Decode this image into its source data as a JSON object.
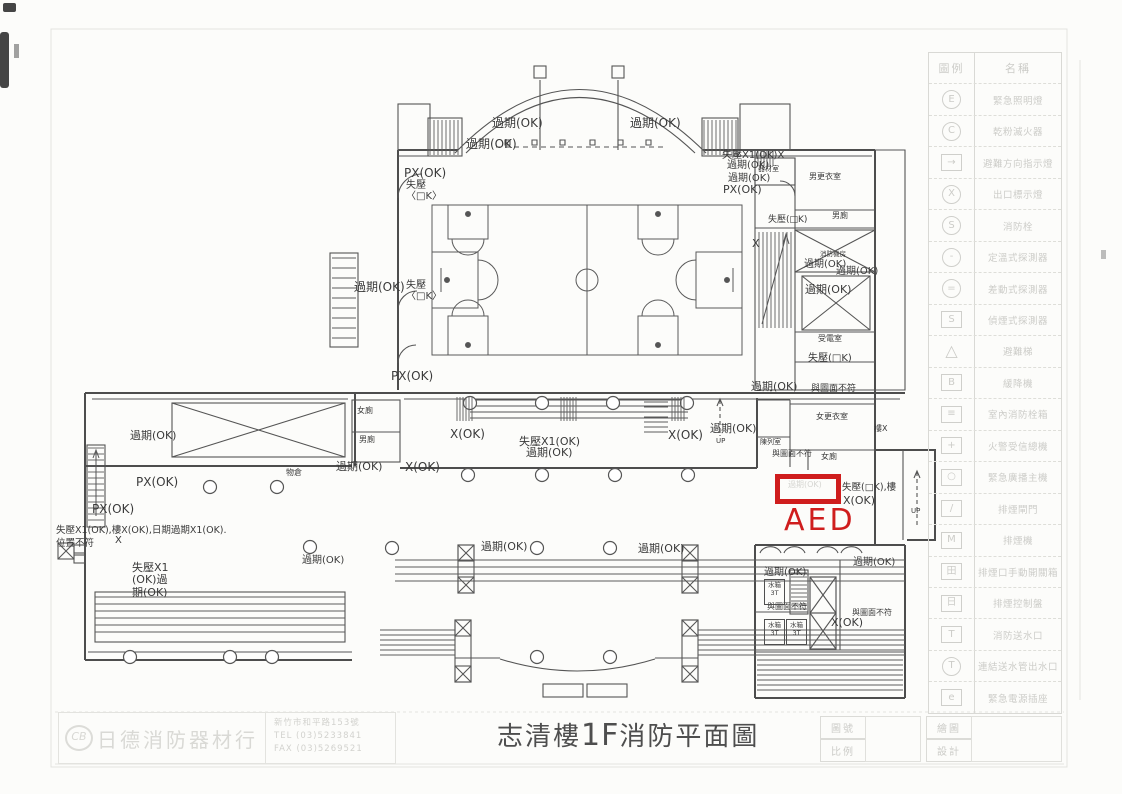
{
  "page": {
    "title_pre": "志清樓",
    "title_floor": "1F",
    "title_post": "消防平面圖"
  },
  "aed": {
    "label": "AED",
    "color": "#cf1d1d"
  },
  "colors": {
    "ink": "#4e4e4e",
    "faint": "#ccccc8",
    "aed_red": "#cf1d1d"
  },
  "annotations": [
    {
      "x": 492,
      "y": 117,
      "t": "過期(OK)",
      "fs": 12
    },
    {
      "x": 630,
      "y": 117,
      "t": "過期(OK)",
      "fs": 12
    },
    {
      "x": 466,
      "y": 138,
      "t": "過期(OK)",
      "fs": 12
    },
    {
      "x": 722,
      "y": 150,
      "t": "失壓X1(OK)X",
      "fs": 10
    },
    {
      "x": 727,
      "y": 160,
      "t": "過期(OK)",
      "fs": 10
    },
    {
      "x": 728,
      "y": 173,
      "t": "過期(OK)",
      "fs": 10
    },
    {
      "x": 723,
      "y": 184,
      "t": "PX(OK)",
      "fs": 11
    },
    {
      "x": 404,
      "y": 167,
      "t": "PX(OK)",
      "fs": 12
    },
    {
      "x": 406,
      "y": 180,
      "t": "失壓",
      "fs": 10
    },
    {
      "x": 406,
      "y": 191,
      "t": "〈□K〉",
      "fs": 10
    },
    {
      "x": 354,
      "y": 281,
      "t": "過期(OK)",
      "fs": 12
    },
    {
      "x": 406,
      "y": 280,
      "t": "失壓",
      "fs": 10
    },
    {
      "x": 406,
      "y": 291,
      "t": "〈□K〉",
      "fs": 10
    },
    {
      "x": 391,
      "y": 370,
      "t": "PX(OK)",
      "fs": 12
    },
    {
      "x": 758,
      "y": 166,
      "t": "器材室",
      "fs": 7
    },
    {
      "x": 809,
      "y": 173,
      "t": "男更衣室",
      "fs": 8
    },
    {
      "x": 832,
      "y": 212,
      "t": "男廁",
      "fs": 8
    },
    {
      "x": 768,
      "y": 215,
      "t": "失壓(□K)",
      "fs": 9
    },
    {
      "x": 752,
      "y": 238,
      "t": "X",
      "fs": 11
    },
    {
      "x": 820,
      "y": 251,
      "t": "消防機房",
      "fs": 6.5
    },
    {
      "x": 804,
      "y": 259,
      "t": "過期(OK)",
      "fs": 10
    },
    {
      "x": 836,
      "y": 266,
      "t": "過期(OK)",
      "fs": 10
    },
    {
      "x": 805,
      "y": 284,
      "t": "過期(OK)",
      "fs": 11
    },
    {
      "x": 818,
      "y": 335,
      "t": "受電室",
      "fs": 8
    },
    {
      "x": 808,
      "y": 353,
      "t": "失壓(□K)",
      "fs": 10
    },
    {
      "x": 751,
      "y": 381,
      "t": "過期(OK)",
      "fs": 11
    },
    {
      "x": 811,
      "y": 384,
      "t": "與圖面不符",
      "fs": 9
    },
    {
      "x": 874,
      "y": 425,
      "t": "樓X",
      "fs": 8
    },
    {
      "x": 816,
      "y": 413,
      "t": "女更衣室",
      "fs": 8
    },
    {
      "x": 760,
      "y": 439,
      "t": "陳列室",
      "fs": 7
    },
    {
      "x": 772,
      "y": 450,
      "t": "與圖面不符",
      "fs": 8
    },
    {
      "x": 821,
      "y": 453,
      "t": "女廁",
      "fs": 8
    },
    {
      "x": 842,
      "y": 483,
      "t": "失壓(□K),樓",
      "fs": 9.5
    },
    {
      "x": 843,
      "y": 495,
      "t": "X(OK)",
      "fs": 11
    },
    {
      "x": 911,
      "y": 508,
      "t": "UP",
      "fs": 7
    },
    {
      "x": 450,
      "y": 428,
      "t": "X(OK)",
      "fs": 12
    },
    {
      "x": 519,
      "y": 436,
      "t": "失壓X1(OK)",
      "fs": 11
    },
    {
      "x": 526,
      "y": 447,
      "t": "過期(OK)",
      "fs": 11
    },
    {
      "x": 668,
      "y": 429,
      "t": "X(OK)",
      "fs": 12
    },
    {
      "x": 710,
      "y": 423,
      "t": "過期(OK)",
      "fs": 11
    },
    {
      "x": 716,
      "y": 438,
      "t": "UP",
      "fs": 7
    },
    {
      "x": 336,
      "y": 461,
      "t": "過期(OK)",
      "fs": 11
    },
    {
      "x": 405,
      "y": 461,
      "t": "X(OK)",
      "fs": 12
    },
    {
      "x": 357,
      "y": 407,
      "t": "女廁",
      "fs": 8
    },
    {
      "x": 359,
      "y": 436,
      "t": "男廁",
      "fs": 8
    },
    {
      "x": 130,
      "y": 430,
      "t": "過期(OK)",
      "fs": 11
    },
    {
      "x": 136,
      "y": 476,
      "t": "PX(OK)",
      "fs": 12
    },
    {
      "x": 92,
      "y": 503,
      "t": "PX(OK)",
      "fs": 12
    },
    {
      "x": 56,
      "y": 526,
      "t": "失壓X1(OK),樓X(OK),日期過期X1(OK).",
      "fs": 9.5
    },
    {
      "x": 56,
      "y": 539,
      "t": "位置不符",
      "fs": 9.5
    },
    {
      "x": 115,
      "y": 535,
      "t": "X",
      "fs": 10
    },
    {
      "x": 286,
      "y": 469,
      "t": "物倉",
      "fs": 8
    },
    {
      "x": 132,
      "y": 562,
      "t": "失壓X1\n(OK)過\n期(OK)",
      "fs": 11
    },
    {
      "x": 302,
      "y": 555,
      "t": "過期(OK)",
      "fs": 10
    },
    {
      "x": 481,
      "y": 541,
      "t": "過期(OK)",
      "fs": 11
    },
    {
      "x": 638,
      "y": 543,
      "t": "過期(OK)",
      "fs": 11
    },
    {
      "x": 764,
      "y": 567,
      "t": "過期(OK)",
      "fs": 10
    },
    {
      "x": 853,
      "y": 557,
      "t": "過期(OK)",
      "fs": 10
    },
    {
      "x": 767,
      "y": 603,
      "t": "與圖面不符",
      "fs": 8
    },
    {
      "x": 852,
      "y": 609,
      "t": "與圖面不符",
      "fs": 8
    },
    {
      "x": 831,
      "y": 617,
      "t": "X(OK)",
      "fs": 11
    },
    {
      "x": 788,
      "y": 481,
      "t": "過期(OK)",
      "fs": 8,
      "c": "#d6d6d2"
    }
  ],
  "water_tank_label": "水箱\n3T",
  "water_tanks": [
    {
      "x": 764,
      "y": 579
    },
    {
      "x": 764,
      "y": 619
    },
    {
      "x": 786,
      "y": 619
    }
  ],
  "legend": {
    "header": {
      "symbol": "圖例",
      "name": "名稱"
    },
    "items": [
      {
        "shape": "c",
        "glyph": "E",
        "label": "緊急照明燈"
      },
      {
        "shape": "c",
        "glyph": "C",
        "label": "乾粉滅火器"
      },
      {
        "shape": "s",
        "glyph": "→",
        "label": "避難方向指示燈"
      },
      {
        "shape": "c",
        "glyph": "X",
        "label": "出口標示燈"
      },
      {
        "shape": "c",
        "glyph": "S",
        "label": "消防栓"
      },
      {
        "shape": "c",
        "glyph": "-",
        "label": "定溫式探測器"
      },
      {
        "shape": "c",
        "glyph": "=",
        "label": "差動式探測器"
      },
      {
        "shape": "s",
        "glyph": "S",
        "label": "偵煙式探測器"
      },
      {
        "shape": "t",
        "glyph": "△",
        "label": "避難梯"
      },
      {
        "shape": "s",
        "glyph": "B",
        "label": "緩降機"
      },
      {
        "shape": "s",
        "glyph": "≡",
        "label": "室內消防栓箱"
      },
      {
        "shape": "s",
        "glyph": "+",
        "label": "火警受信總機"
      },
      {
        "shape": "s",
        "glyph": "○",
        "label": "緊急廣播主機"
      },
      {
        "shape": "s",
        "glyph": "/",
        "label": "排煙閘門"
      },
      {
        "shape": "s",
        "glyph": "M",
        "label": "排煙機"
      },
      {
        "shape": "s",
        "glyph": "田",
        "label": "排煙口手動開關箱"
      },
      {
        "shape": "s",
        "glyph": "日",
        "label": "排煙控制盤"
      },
      {
        "shape": "s",
        "glyph": "T",
        "label": "消防送水口"
      },
      {
        "shape": "c",
        "glyph": "T",
        "label": "連結送水管出水口"
      },
      {
        "shape": "s",
        "glyph": "e",
        "label": "緊急電源插座"
      }
    ]
  },
  "title_block": {
    "left_rows": [
      "圖號",
      "比例"
    ],
    "right_rows": [
      "繪圖",
      "設計"
    ]
  },
  "company": {
    "mark": "CB",
    "name": "日德消防器材行",
    "address": "新竹市和平路153號",
    "tel": "TEL (03)5233841",
    "fax": "FAX (03)5269521"
  }
}
